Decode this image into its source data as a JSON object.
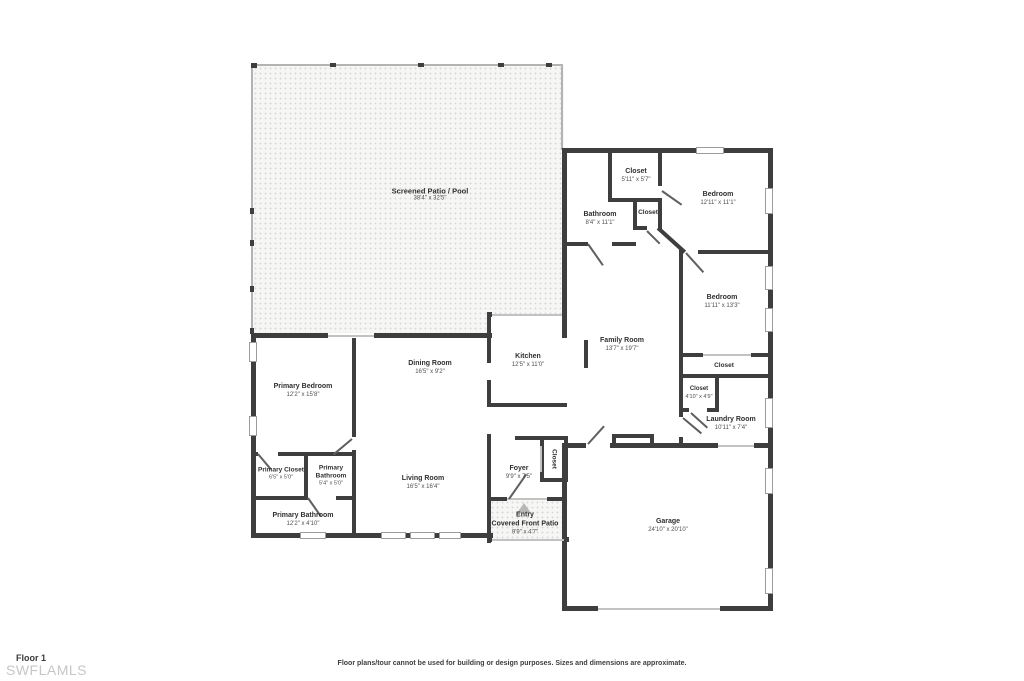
{
  "footer": {
    "floor_label": "Floor 1",
    "watermark": "SWFLAMLS",
    "disclaimer": "Floor plans/tour cannot be used for building or design purposes. Sizes and dimensions are approximate."
  },
  "colors": {
    "wall": "#3e3e3e",
    "patio_dots": "#d9d9d9",
    "room_text": "#2f2f2f",
    "dims_text": "#4f4f4f",
    "watermark": "#c6c6c6",
    "entry_arrow": "#b8b8b8"
  },
  "rooms": {
    "patio": {
      "name": "Screened Patio / Pool",
      "dims": "38'4\" x 32'5\""
    },
    "closet_top": {
      "name": "Closet",
      "dims": "5'11\" x 5'7\""
    },
    "bathroom": {
      "name": "Bathroom",
      "dims": "8'4\" x 11'1\""
    },
    "closet_hall": {
      "name": "Closet"
    },
    "bedroom_top": {
      "name": "Bedroom",
      "dims": "12'11\" x 11'1\""
    },
    "bedroom_right": {
      "name": "Bedroom",
      "dims": "11'11\" x 13'3\""
    },
    "family_room": {
      "name": "Family Room",
      "dims": "13'7\" x 19'7\""
    },
    "kitchen": {
      "name": "Kitchen",
      "dims": "12'5\" x 11'0\""
    },
    "dining_room": {
      "name": "Dining Room",
      "dims": "16'5\" x 9'2\""
    },
    "primary_bedroom": {
      "name": "Primary Bedroom",
      "dims": "12'2\" x 15'8\""
    },
    "primary_closet": {
      "name": "Primary Closet",
      "dims": "6'5\" x 5'0\""
    },
    "primary_bathroom_small": {
      "name": "Primary Bathroom",
      "dims": "5'4\" x 5'0\""
    },
    "primary_bathroom": {
      "name": "Primary Bathroom",
      "dims": "12'2\" x 4'10\""
    },
    "living_room": {
      "name": "Living Room",
      "dims": "16'5\" x 16'4\""
    },
    "foyer": {
      "name": "Foyer",
      "dims": "9'9\" x 7'5\""
    },
    "foyer_closet": {
      "name": "Closet"
    },
    "entry": {
      "name": "Entry",
      "name2": "Covered Front Patio",
      "dims": "9'9\" x 4'7\""
    },
    "closet_wide": {
      "name": "Closet"
    },
    "closet_laundry": {
      "name": "Closet",
      "dims": "4'10\" x 4'9\""
    },
    "laundry_room": {
      "name": "Laundry Room",
      "dims": "10'11\" x 7'4\""
    },
    "garage": {
      "name": "Garage",
      "dims": "24'10\" x 20'10\""
    }
  }
}
